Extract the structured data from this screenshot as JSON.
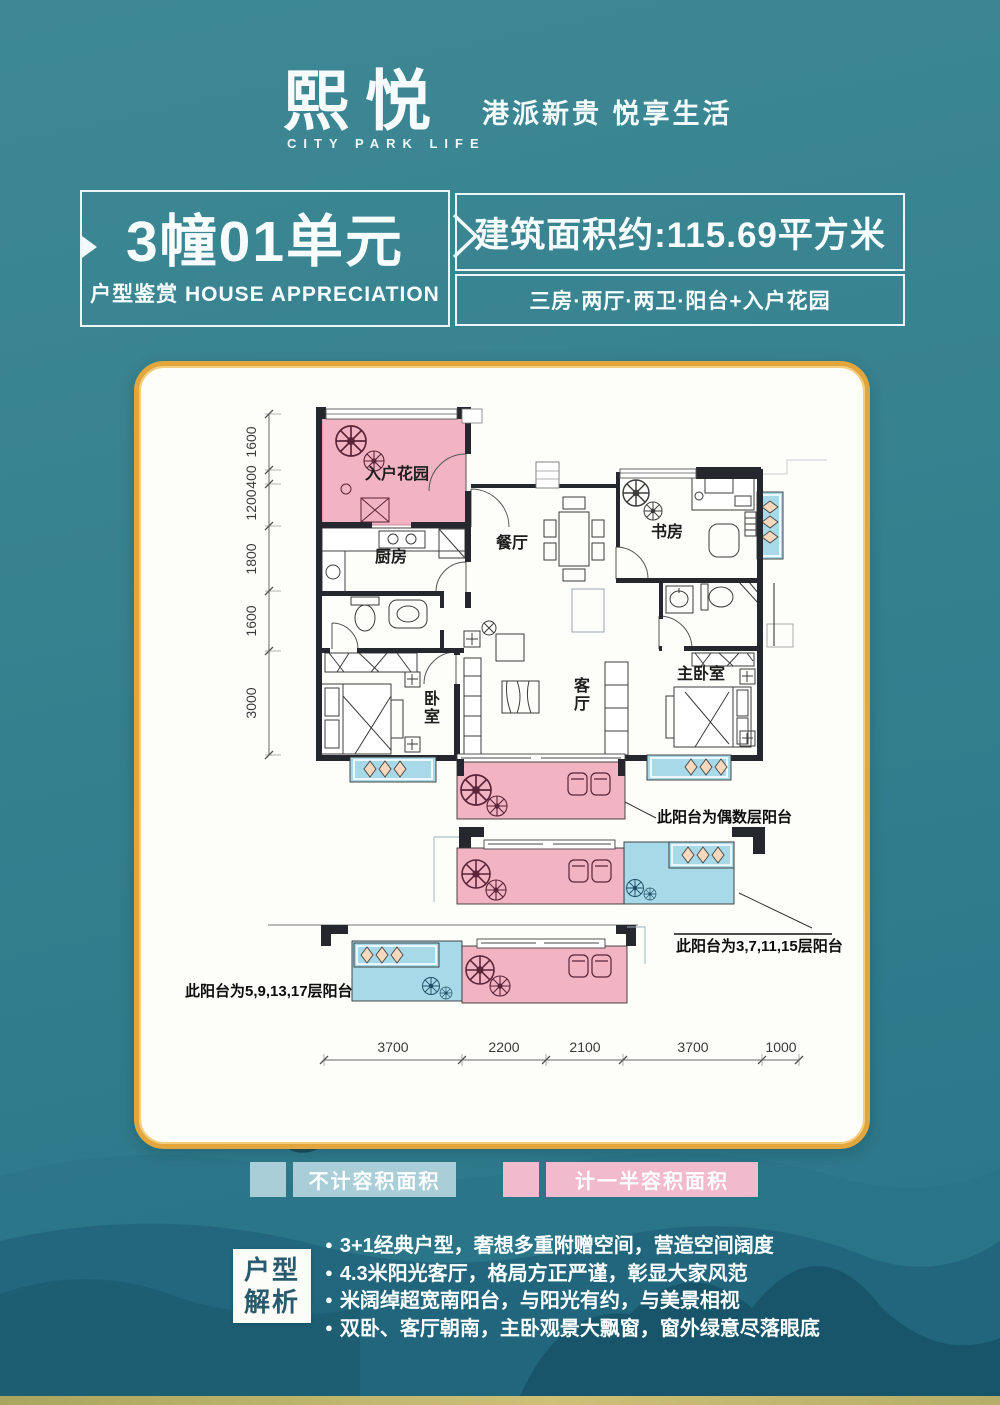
{
  "brand": {
    "logo": "熙悦",
    "logo_sub": "CITY PARK LIFE",
    "tagline": "港派新贵 悦享生活"
  },
  "title": {
    "unit": "3幢01单元",
    "subtitle": "户型鉴赏 HOUSE APPRECIATION",
    "area": "建筑面积约:115.69平方米",
    "layout_desc": "三房·两厅·两卫·阳台+入户花园"
  },
  "plan": {
    "rooms": {
      "garden": "入户花园",
      "kitchen": "厨房",
      "dining": "餐厅",
      "study": "书房",
      "bedroom": "卧室",
      "living": "客厅",
      "master": "主卧室"
    },
    "dims_vertical": [
      "1600",
      "400",
      "1200",
      "1800",
      "1600",
      "3000"
    ],
    "dims_horizontal": [
      "3700",
      "2200",
      "2100",
      "3700",
      "1000"
    ],
    "balcony_notes": {
      "even": "此阳台为偶数层阳台",
      "odd_a": "此阳台为3,7,11,15层阳台",
      "odd_b": "此阳台为5,9,13,17层阳台"
    }
  },
  "legend": {
    "items": [
      {
        "label": "不计容积面积",
        "color": "#a9ced8"
      },
      {
        "label": "计一半容积面积",
        "color": "#f2bacd"
      }
    ]
  },
  "analysis": {
    "box_lines": [
      "户型",
      "解析"
    ],
    "bullets": [
      "3+1经典户型，奢想多重附赠空间，营造空间阔度",
      "4.3米阳光客厅，格局方正严谨，彰显大家风范",
      "米阔绰超宽南阳台，与阳光有约，与美景相视",
      "双卧、客厅朝南，主卧观景大飘窗，窗外绿意尽落眼底"
    ]
  },
  "colors": {
    "background_teal": "#33808f",
    "card_border_gold": "#e2a63c",
    "balcony_pink": "#f2b3c3",
    "balcony_blue": "#a8d9e8",
    "wall_dark": "#26262e"
  }
}
